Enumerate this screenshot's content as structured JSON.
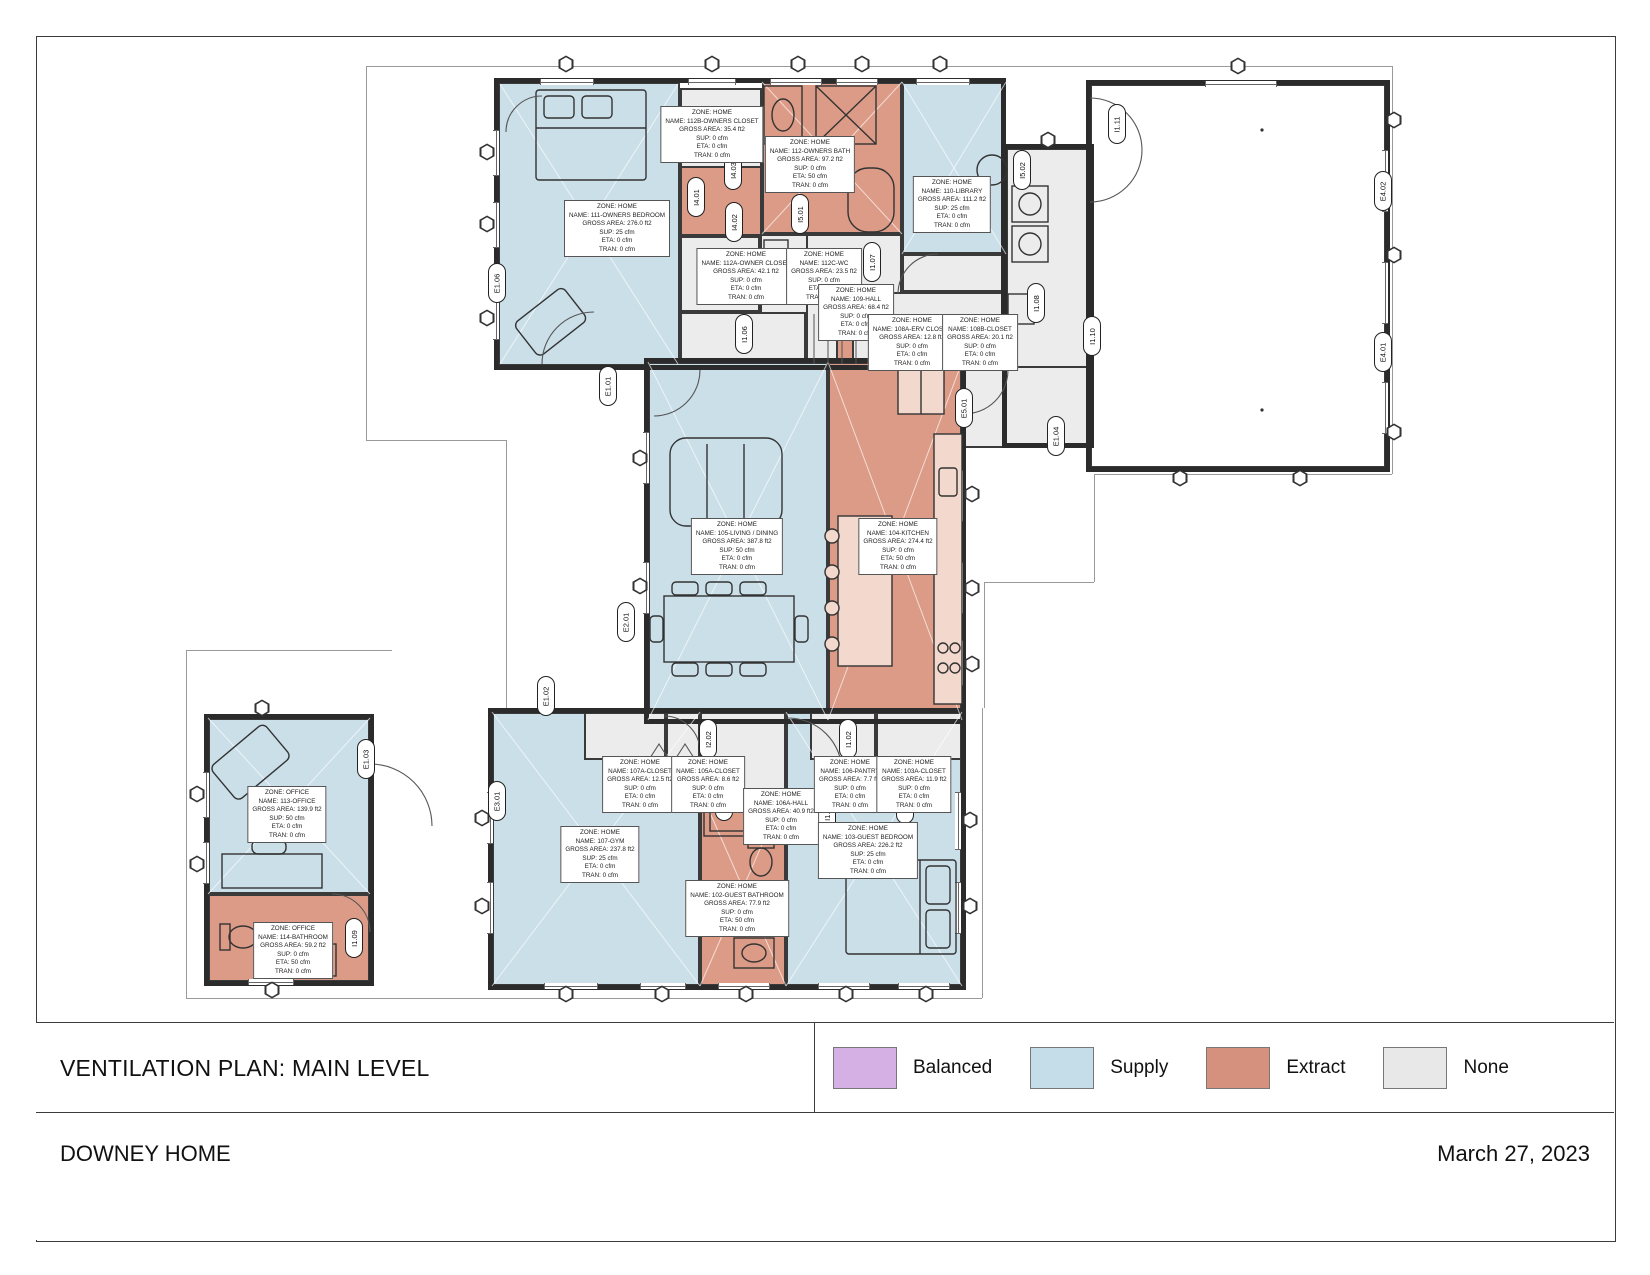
{
  "title_block": {
    "plan_title": "VENTILATION PLAN: MAIN LEVEL",
    "project_name": "DOWNEY HOME",
    "date": "March 27, 2023"
  },
  "legend": {
    "items": [
      {
        "label": "Balanced",
        "color": "#d5b0e4"
      },
      {
        "label": "Supply",
        "color": "#c4dde9"
      },
      {
        "label": "Extract",
        "color": "#d5917e"
      },
      {
        "label": "None",
        "color": "#e8e8e8"
      }
    ]
  },
  "colors": {
    "supply_zone": "#cbdfe9",
    "extract_zone": "#dc9b87",
    "none_zone": "#ececec",
    "wall": "#2b2b2b"
  },
  "zones": [
    {
      "zone": "ZONE: HOME",
      "name": "NAME: 111-OWNERS BEDROOM",
      "area": "GROSS AREA: 276.0 ft2",
      "sup": "SUP: 25 cfm",
      "eta": "ETA: 0 cfm",
      "tran": "TRAN: 0 cfm"
    },
    {
      "zone": "ZONE: HOME",
      "name": "NAME: 112B-OWNERS CLOSET",
      "area": "GROSS AREA: 35.4 ft2",
      "sup": "SUP: 0 cfm",
      "eta": "ETA: 0 cfm",
      "tran": "TRAN: 0 cfm"
    },
    {
      "zone": "ZONE: HOME",
      "name": "NAME: 112-OWNERS BATH",
      "area": "GROSS AREA: 97.2 ft2",
      "sup": "SUP: 0 cfm",
      "eta": "ETA: 50 cfm",
      "tran": "TRAN: 0 cfm"
    },
    {
      "zone": "ZONE: HOME",
      "name": "NAME: 112A-OWNER CLOSET",
      "area": "GROSS AREA: 42.1 ft2",
      "sup": "SUP: 0 cfm",
      "eta": "ETA: 0 cfm",
      "tran": "TRAN: 0 cfm"
    },
    {
      "zone": "ZONE: HOME",
      "name": "NAME: 112C-WC",
      "area": "GROSS AREA: 23.5 ft2",
      "sup": "SUP: 0 cfm",
      "eta": "ETA: 0 cfm",
      "tran": "TRAN: 0 cfm"
    },
    {
      "zone": "ZONE: HOME",
      "name": "NAME: 109-HALL",
      "area": "GROSS AREA: 68.4 ft2",
      "sup": "SUP: 0 cfm",
      "eta": "ETA: 0 cfm",
      "tran": "TRAN: 0 cfm"
    },
    {
      "zone": "ZONE: HOME",
      "name": "NAME: 110-LIBRARY",
      "area": "GROSS AREA: 111.2 ft2",
      "sup": "SUP: 25 cfm",
      "eta": "ETA: 0 cfm",
      "tran": "TRAN: 0 cfm"
    },
    {
      "zone": "ZONE: HOME",
      "name": "NAME: 108A-ERV CLOSET",
      "area": "GROSS AREA: 12.8 ft2",
      "sup": "SUP: 0 cfm",
      "eta": "ETA: 0 cfm",
      "tran": "TRAN: 0 cfm"
    },
    {
      "zone": "ZONE: HOME",
      "name": "NAME: 108B-CLOSET",
      "area": "GROSS AREA: 20.1 ft2",
      "sup": "SUP: 0 cfm",
      "eta": "ETA: 0 cfm",
      "tran": "TRAN: 0 cfm"
    },
    {
      "zone": "ZONE: HOME",
      "name": "NAME: 105-LIVING / DINING",
      "area": "GROSS AREA: 387.8 ft2",
      "sup": "SUP: 50 cfm",
      "eta": "ETA: 0 cfm",
      "tran": "TRAN: 0 cfm"
    },
    {
      "zone": "ZONE: HOME",
      "name": "NAME: 104-KITCHEN",
      "area": "GROSS AREA: 274.4 ft2",
      "sup": "SUP: 0 cfm",
      "eta": "ETA: 50 cfm",
      "tran": "TRAN: 0 cfm"
    },
    {
      "zone": "ZONE: HOME",
      "name": "NAME: 107A-CLOSET",
      "area": "GROSS AREA: 12.5 ft2",
      "sup": "SUP: 0 cfm",
      "eta": "ETA: 0 cfm",
      "tran": "TRAN: 0 cfm"
    },
    {
      "zone": "ZONE: HOME",
      "name": "NAME: 105A-CLOSET",
      "area": "GROSS AREA: 8.6 ft2",
      "sup": "SUP: 0 cfm",
      "eta": "ETA: 0 cfm",
      "tran": "TRAN: 0 cfm"
    },
    {
      "zone": "ZONE: HOME",
      "name": "NAME: 106A-HALL",
      "area": "GROSS AREA: 40.9 ft2",
      "sup": "SUP: 0 cfm",
      "eta": "ETA: 0 cfm",
      "tran": "TRAN: 0 cfm"
    },
    {
      "zone": "ZONE: HOME",
      "name": "NAME: 106-PANTRY",
      "area": "GROSS AREA: 7.7 ft2",
      "sup": "SUP: 0 cfm",
      "eta": "ETA: 0 cfm",
      "tran": "TRAN: 0 cfm"
    },
    {
      "zone": "ZONE: HOME",
      "name": "NAME: 103A-CLOSET",
      "area": "GROSS AREA: 11.9 ft2",
      "sup": "SUP: 0 cfm",
      "eta": "ETA: 0 cfm",
      "tran": "TRAN: 0 cfm"
    },
    {
      "zone": "ZONE: HOME",
      "name": "NAME: 107-GYM",
      "area": "GROSS AREA: 237.8 ft2",
      "sup": "SUP: 25 cfm",
      "eta": "ETA: 0 cfm",
      "tran": "TRAN: 0 cfm"
    },
    {
      "zone": "ZONE: HOME",
      "name": "NAME: 102-GUEST BATHROOM",
      "area": "GROSS AREA: 77.9 ft2",
      "sup": "SUP: 0 cfm",
      "eta": "ETA: 50 cfm",
      "tran": "TRAN: 0 cfm"
    },
    {
      "zone": "ZONE: HOME",
      "name": "NAME: 103-GUEST BEDROOM",
      "area": "GROSS AREA: 226.2 ft2",
      "sup": "SUP: 25 cfm",
      "eta": "ETA: 0 cfm",
      "tran": "TRAN: 0 cfm"
    },
    {
      "zone": "ZONE: OFFICE",
      "name": "NAME: 113-OFFICE",
      "area": "GROSS AREA: 139.9 ft2",
      "sup": "SUP: 50 cfm",
      "eta": "ETA: 0 cfm",
      "tran": "TRAN: 0 cfm"
    },
    {
      "zone": "ZONE: OFFICE",
      "name": "NAME: 114-BATHROOM",
      "area": "GROSS AREA: 59.2 ft2",
      "sup": "SUP: 0 cfm",
      "eta": "ETA: 50 cfm",
      "tran": "TRAN: 0 cfm"
    }
  ],
  "markers": [
    "E1.06",
    "E1.01",
    "I4.01",
    "I4.03",
    "I4.02",
    "I5.01",
    "I1.07",
    "I1.06",
    "I1.08",
    "I1.10",
    "I1.11",
    "E4.02",
    "E4.01",
    "I5.02",
    "E5.01",
    "E1.04",
    "E2.01",
    "E1.02",
    "I2.02",
    "I1.02",
    "E3.01",
    "E1.03",
    "I1.04",
    "I3.01",
    "I1.03",
    "I1.09"
  ]
}
